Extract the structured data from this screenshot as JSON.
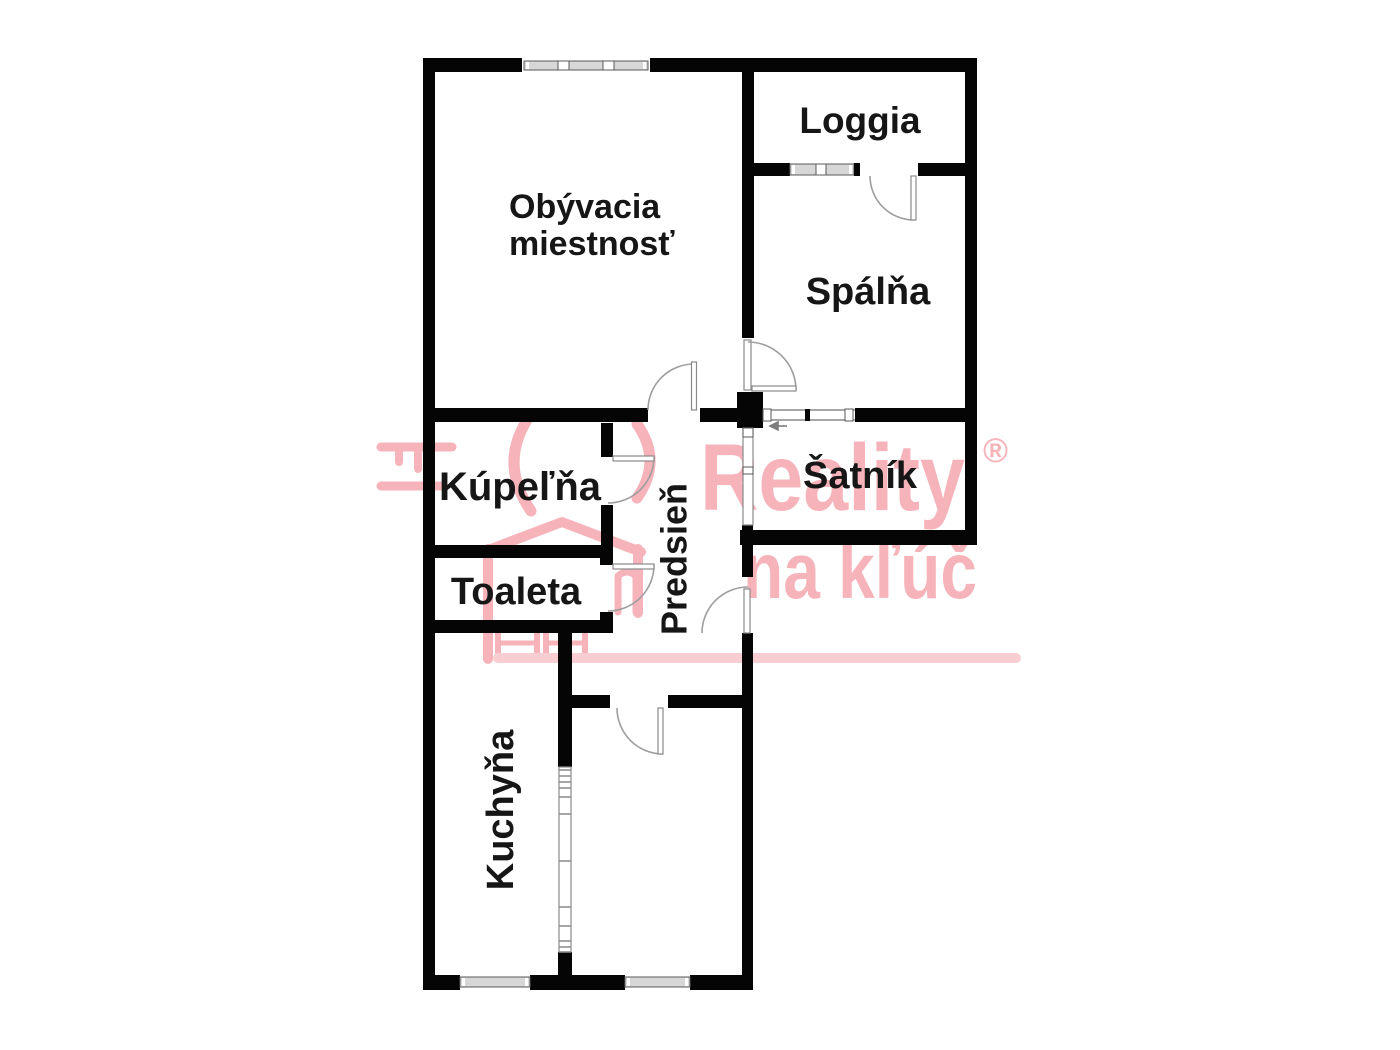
{
  "document": {
    "type": "apartment-floor-plan"
  },
  "rooms": {
    "living": {
      "label": "Obývacia miestnosť",
      "line1": "Obývacia",
      "line2": "miestnosť"
    },
    "loggia": {
      "label": "Loggia"
    },
    "bedroom": {
      "label": "Spálňa"
    },
    "wardrobe": {
      "label": "Šatník"
    },
    "bathroom": {
      "label": "Kúpeľňa"
    },
    "toilet": {
      "label": "Toaleta"
    },
    "hallway": {
      "label": "Predsieň"
    },
    "kitchen": {
      "label": "Kuchyňa"
    }
  },
  "watermark": {
    "brand_line1": "Reality",
    "brand_line2": "na kľúč",
    "registered_mark": "®"
  },
  "colors": {
    "wall-color": "#050505",
    "window-fill": "#d7d7d7",
    "door-color": "#9e9e9e",
    "wm-pink": "#f6b4ba",
    "wm-pink-light": "#f9ced2"
  }
}
